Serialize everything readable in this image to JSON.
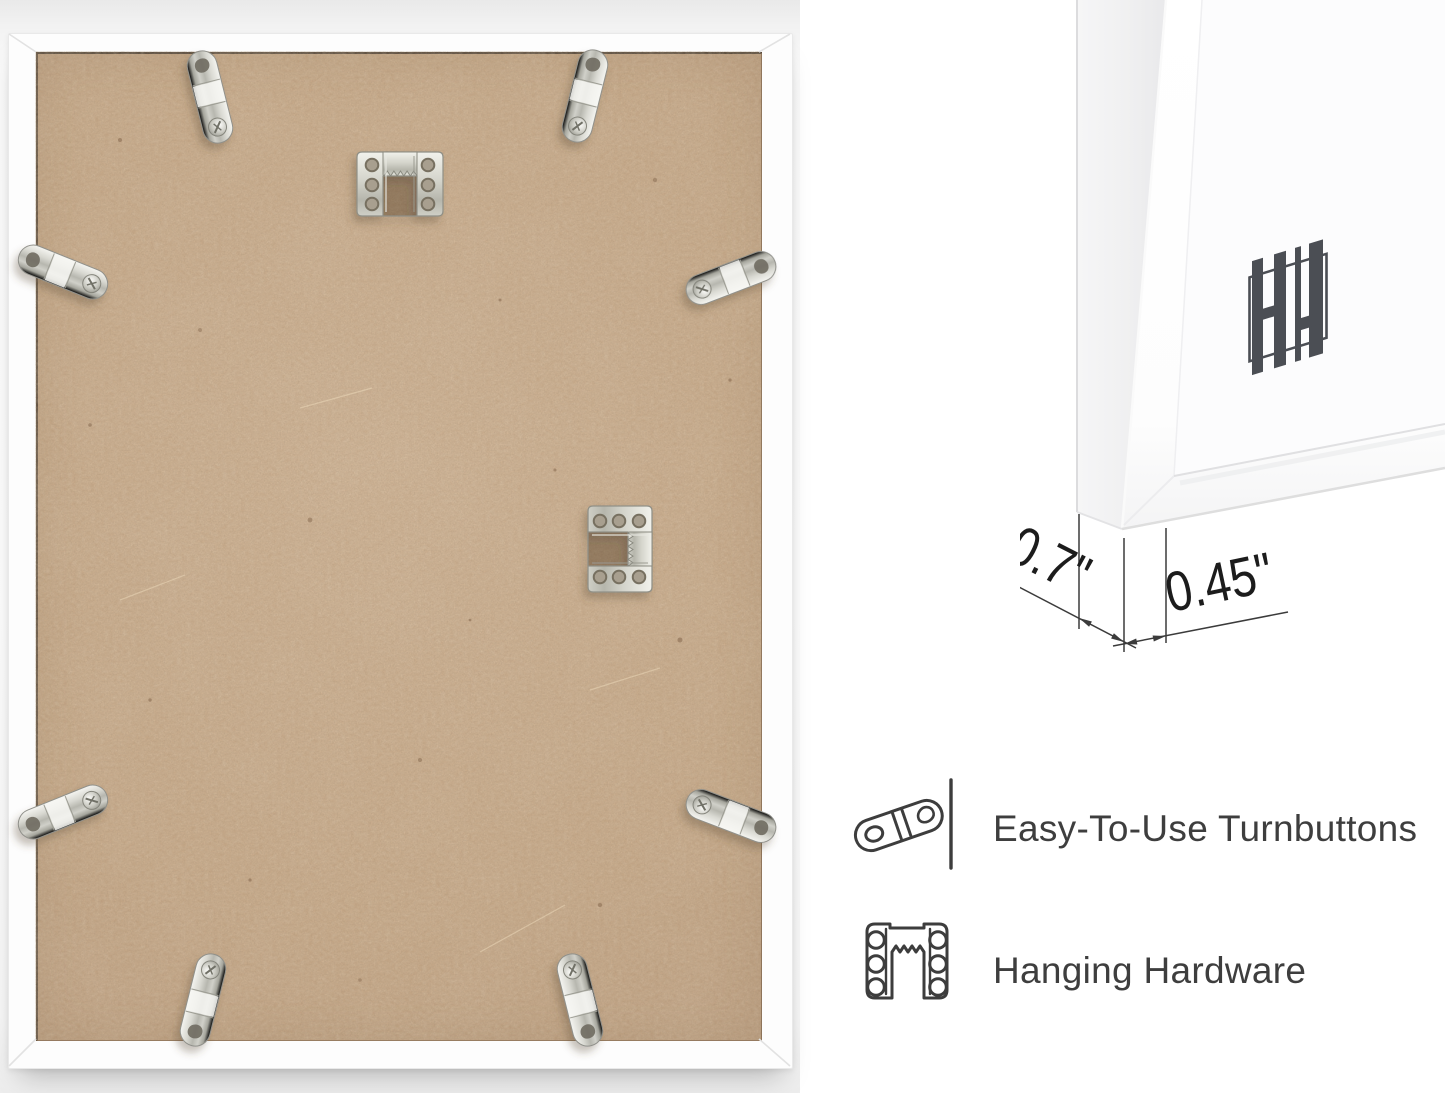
{
  "page": {
    "background": "#ffffff"
  },
  "back_view": {
    "turnbutton_count": 8,
    "sawtooth_hanger_count": 2
  },
  "corner_detail": {
    "logo_icon": "hh-monogram-logo"
  },
  "dimensions": {
    "depth": "0.7\"",
    "moulding_width": "0.45\""
  },
  "features": [
    {
      "icon": "turnbutton-icon",
      "label": "Easy-To-Use Turnbuttons"
    },
    {
      "icon": "sawtooth-hanger-icon",
      "label": "Hanging Hardware"
    }
  ],
  "colors": {
    "board": "#c8a787",
    "frame": "#ffffff",
    "metal": "#c6c6bf",
    "label_text": "#3e3e3e",
    "dimension_text": "#1c1c1c",
    "logo": "#4b4e54"
  }
}
